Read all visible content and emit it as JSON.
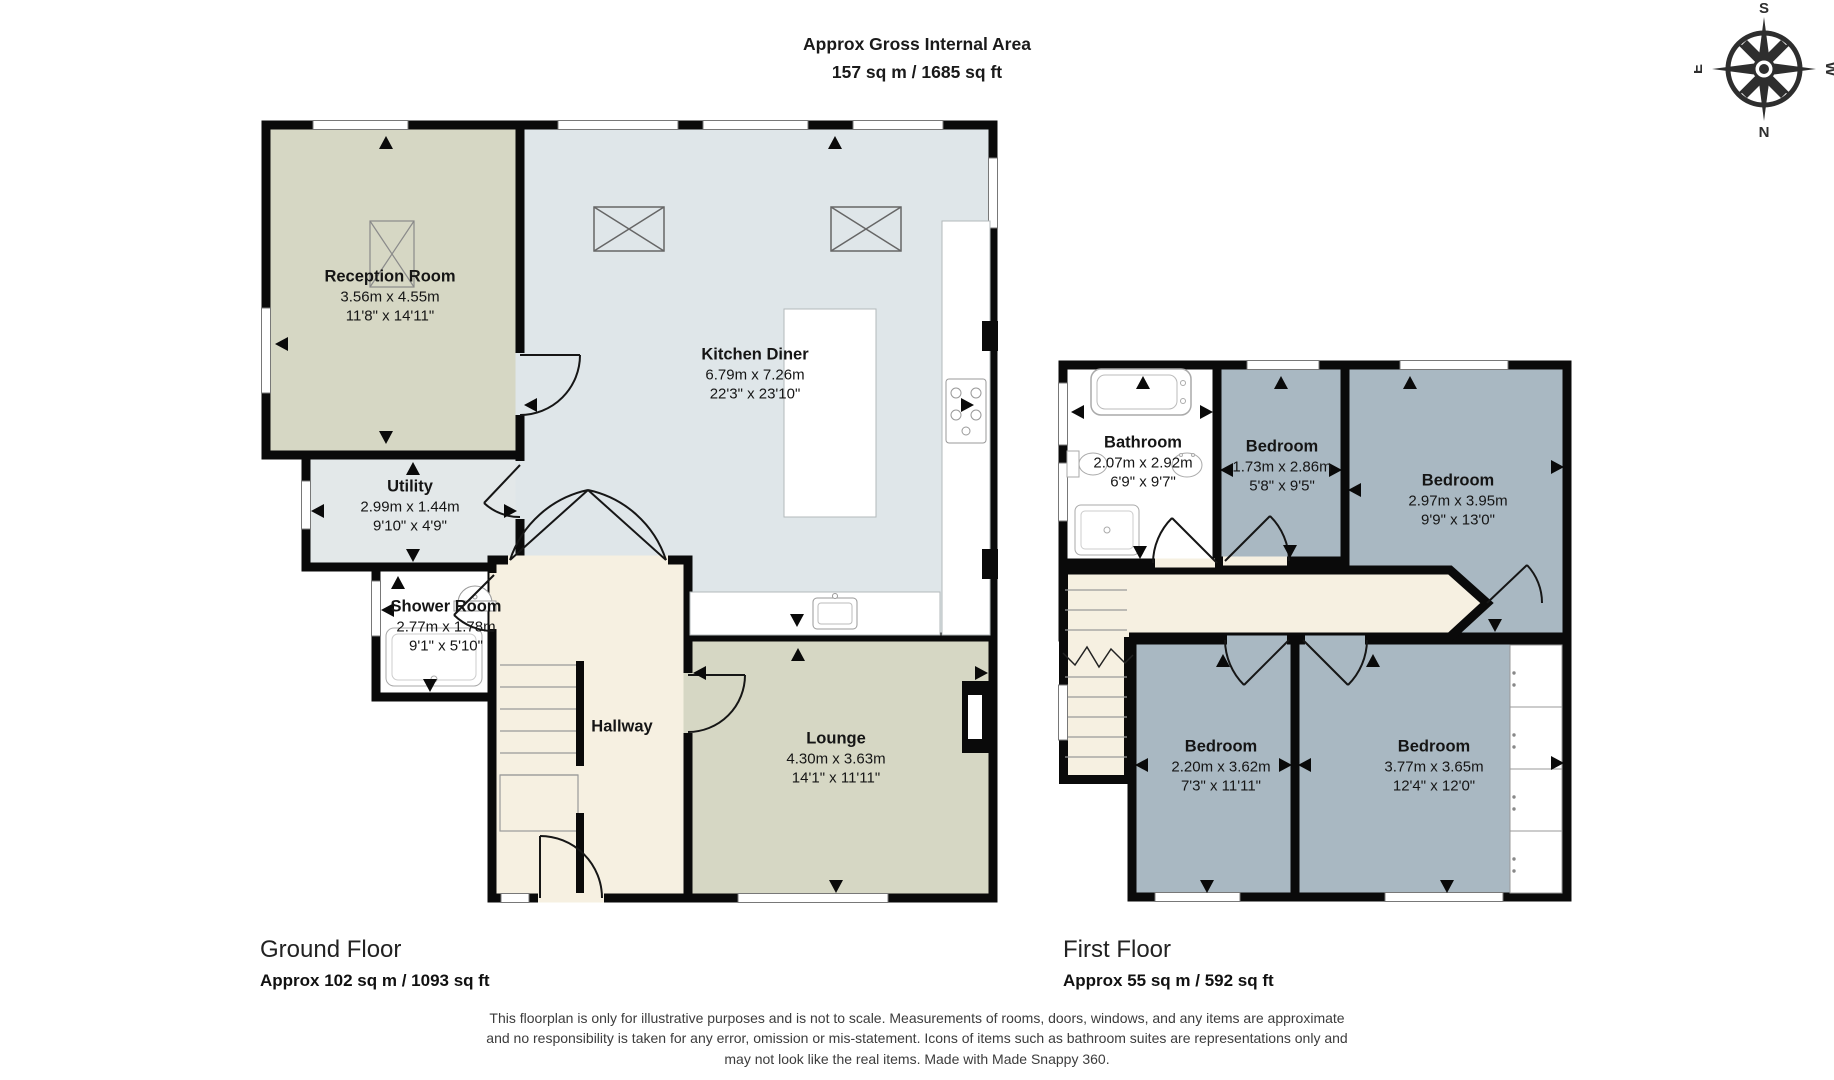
{
  "header": {
    "title_line1": "Approx Gross Internal Area",
    "title_line2": "157 sq m / 1685 sq ft"
  },
  "compass": {
    "top": "S",
    "bottom": "N",
    "left": "E",
    "right": "W"
  },
  "floors": [
    {
      "heading": "Ground Floor",
      "area": "Approx 102 sq m / 1093 sq ft",
      "rooms": [
        {
          "name": "Reception Room",
          "metric": "3.56m x 4.55m",
          "imperial": "11'8\" x 14'11\""
        },
        {
          "name": "Kitchen Diner",
          "metric": "6.79m x 7.26m",
          "imperial": "22'3\" x 23'10\""
        },
        {
          "name": "Utility",
          "metric": "2.99m x 1.44m",
          "imperial": "9'10\" x 4'9\""
        },
        {
          "name": "Shower Room",
          "metric": "2.77m x 1.78m",
          "imperial": "9'1\" x 5'10\""
        },
        {
          "name": "Hallway",
          "metric": "",
          "imperial": ""
        },
        {
          "name": "Lounge",
          "metric": "4.30m x 3.63m",
          "imperial": "14'1\" x 11'11\""
        }
      ]
    },
    {
      "heading": "First Floor",
      "area": "Approx 55 sq m / 592 sq ft",
      "rooms": [
        {
          "name": "Bathroom",
          "metric": "2.07m x 2.92m",
          "imperial": "6'9\" x 9'7\""
        },
        {
          "name": "Bedroom",
          "metric": "1.73m x 2.86m",
          "imperial": "5'8\" x 9'5\""
        },
        {
          "name": "Bedroom",
          "metric": "2.97m x 3.95m",
          "imperial": "9'9\" x 13'0\""
        },
        {
          "name": "Bedroom",
          "metric": "2.20m x 3.62m",
          "imperial": "7'3\" x 11'11\""
        },
        {
          "name": "Bedroom",
          "metric": "3.77m x 3.65m",
          "imperial": "12'4\" x 12'0\""
        }
      ]
    }
  ],
  "disclaimer": {
    "line1": "This floorplan is only for illustrative purposes and is not to scale. Measurements of rooms, doors, windows, and any items are approximate",
    "line2": "and no responsibility is taken for any error, omission or mis-statement. Icons of items such as bathroom suites are representations only and",
    "line3": "may not look like the real items. Made with Made Snappy 360."
  },
  "colors": {
    "wall": "#0a0a0a",
    "reception_lounge_floor": "#d6d7c4",
    "kitchen_floor": "#dfe6e9",
    "utility_floor": "#e3e8e9",
    "hallway_floor": "#f6f0e1",
    "bedroom_floor": "#a9b8c2",
    "bathroom_floor": "#ffffff"
  }
}
